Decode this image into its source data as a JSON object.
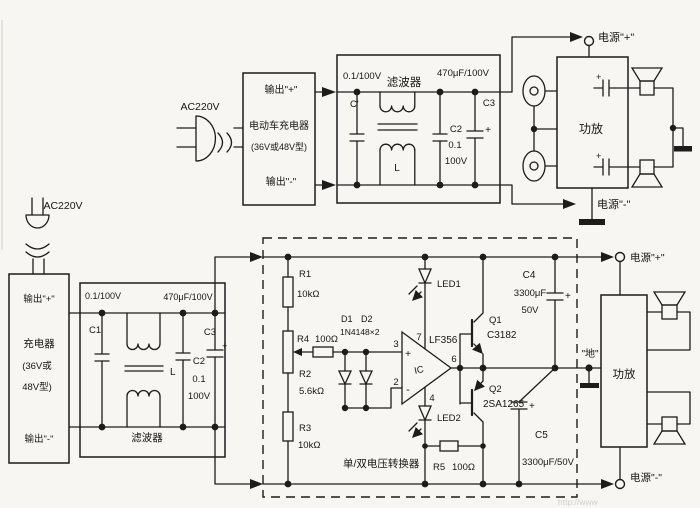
{
  "top": {
    "ac_label": "AC220V",
    "charger": {
      "out_plus": "输出\"+\"",
      "name": "电动车充电器",
      "type": "(36V或48V型)",
      "out_minus": "输出\"-\""
    },
    "filter": {
      "title": "滤波器",
      "c_in_label": "C'",
      "c_in_value": "0.1/100V",
      "l_label": "L",
      "c2_label": "C2",
      "c2_value_1": "0.1",
      "c2_value_2": "100V",
      "c3_label": "C3",
      "c3_value": "470μF/100V",
      "c3_plus": "+"
    },
    "amp_label": "功放",
    "cap_plus_top": "+",
    "cap_plus_bottom": "+",
    "power_plus": "电源\"+\"",
    "power_minus": "电源\"-\""
  },
  "bottom": {
    "ac_label": "AC220V",
    "charger": {
      "out_plus": "输出\"+\"",
      "name": "充电器",
      "type_1": "(36V或",
      "type_2": "48V型)",
      "out_minus": "输出\"-\""
    },
    "filter": {
      "title": "滤波器",
      "c1_label": "C1",
      "c1_value": "0.1/100V",
      "l_label": "L",
      "c2_label": "C2",
      "c2_value_1": "0.1",
      "c2_value_2": "100V",
      "c3_label": "C3",
      "c3_value": "470μF/100V",
      "c3_plus": "+"
    },
    "converter_label": "单/双电压转换器",
    "r1_label": "R1",
    "r1_value": "10kΩ",
    "r2_label": "R2",
    "r2_value": "5.6kΩ",
    "r3_label": "R3",
    "r3_value": "10kΩ",
    "r4_label": "R4",
    "r4_value": "100Ω",
    "r5_label": "R5",
    "r5_value": "100Ω",
    "d1_label": "D1",
    "d2_label": "D2",
    "d_value": "1N4148×2",
    "led1_label": "LED1",
    "led2_label": "LED2",
    "opamp": {
      "ic_label": "IC",
      "model": "LF356",
      "pin2": "2",
      "pin3": "3",
      "pin4": "4",
      "pin6": "6",
      "pin7": "7",
      "plus": "+",
      "minus": "-"
    },
    "q1_label": "Q1",
    "q1_model": "C3182",
    "q2_label": "Q2",
    "q2_model": "2SA1265",
    "c4_label": "C4",
    "c4_value_1": "3300μF",
    "c4_value_2": "50V",
    "c4_plus": "+",
    "c5_label": "C5",
    "c5_value": "3300μF/50V",
    "c5_plus": "+",
    "ground_label": "\"地\"",
    "amp_label": "功放",
    "power_plus": "电源\"+\"",
    "power_minus": "电源\"-\""
  },
  "watermark": "http://www"
}
